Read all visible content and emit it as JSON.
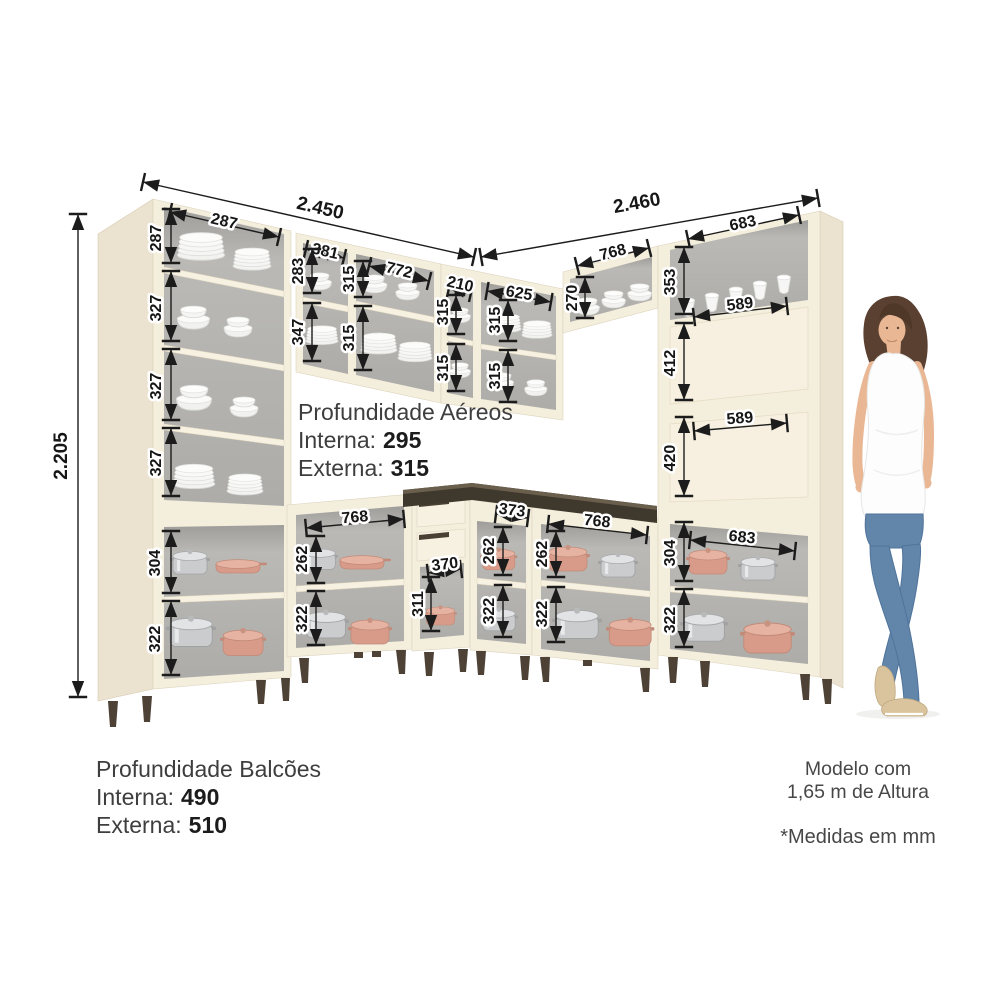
{
  "colors": {
    "cream": "#f4eedd",
    "cream_dark": "#ebe2cf",
    "shelf": "#f7f1e1",
    "interior_gray": "#b3b2ae",
    "countertop": "#3f382d",
    "countertop_top": "#6a5f4c",
    "pot_salmon": "#d99b89",
    "pot_salmon_light": "#e6b2a2",
    "pot_steel": "#cbccce",
    "leg": "#4e4237",
    "dim_line": "#1c1c1c",
    "jeans": "#6286a9",
    "skin": "#eab795",
    "hair": "#5a4030",
    "shoe": "#d9c49e"
  },
  "overall": {
    "height": "2.205",
    "left_run_width": "2.450",
    "right_run_width": "2.460"
  },
  "left_tall_cabinet": {
    "inner_width": "287",
    "row1": "287",
    "row2": "327",
    "row3": "327",
    "row4": "327",
    "base_row1": "304",
    "base_row2": "322"
  },
  "left_wall_cabinet": {
    "col1_width": "381",
    "col1_row1": "283",
    "col1_row2": "347",
    "col2_width": "772",
    "col2_row1": "315",
    "col2_row2": "315"
  },
  "corner_wall_cabinet": {
    "small_width": "210",
    "small_row1": "315",
    "small_row2": "315",
    "wide_width": "625",
    "wide_row1": "315",
    "wide_row2": "315"
  },
  "right_wall_cabinet": {
    "width": "768",
    "row": "270"
  },
  "right_tall_cabinet": {
    "top_width": "683",
    "top_row": "353",
    "niche1_width": "589",
    "niche1_height": "412",
    "niche2_width": "589",
    "niche2_height": "420",
    "base_width": "683",
    "base_row1": "304",
    "base_row2": "322"
  },
  "left_base_cabinet": {
    "width": "768",
    "row1": "262",
    "row2": "322"
  },
  "corner_base_cabinet": {
    "opening_width": "370",
    "opening_height": "311"
  },
  "corner_right_base_cabinet": {
    "width": "373",
    "row1": "262",
    "row2": "322"
  },
  "right_base_cabinet": {
    "width": "768",
    "row1": "262",
    "row2": "322"
  },
  "notes": {
    "aereos": {
      "title": "Profundidade Aéreos",
      "interna_label": "Interna:",
      "interna_value": "295",
      "externa_label": "Externa:",
      "externa_value": "315"
    },
    "balcoes": {
      "title": "Profundidade Balcões",
      "interna_label": "Interna:",
      "interna_value": "490",
      "externa_label": "Externa:",
      "externa_value": "510"
    },
    "modelo": {
      "line1": "Modelo com",
      "line2": "1,65 m de Altura"
    },
    "medidas": "*Medidas em mm"
  }
}
